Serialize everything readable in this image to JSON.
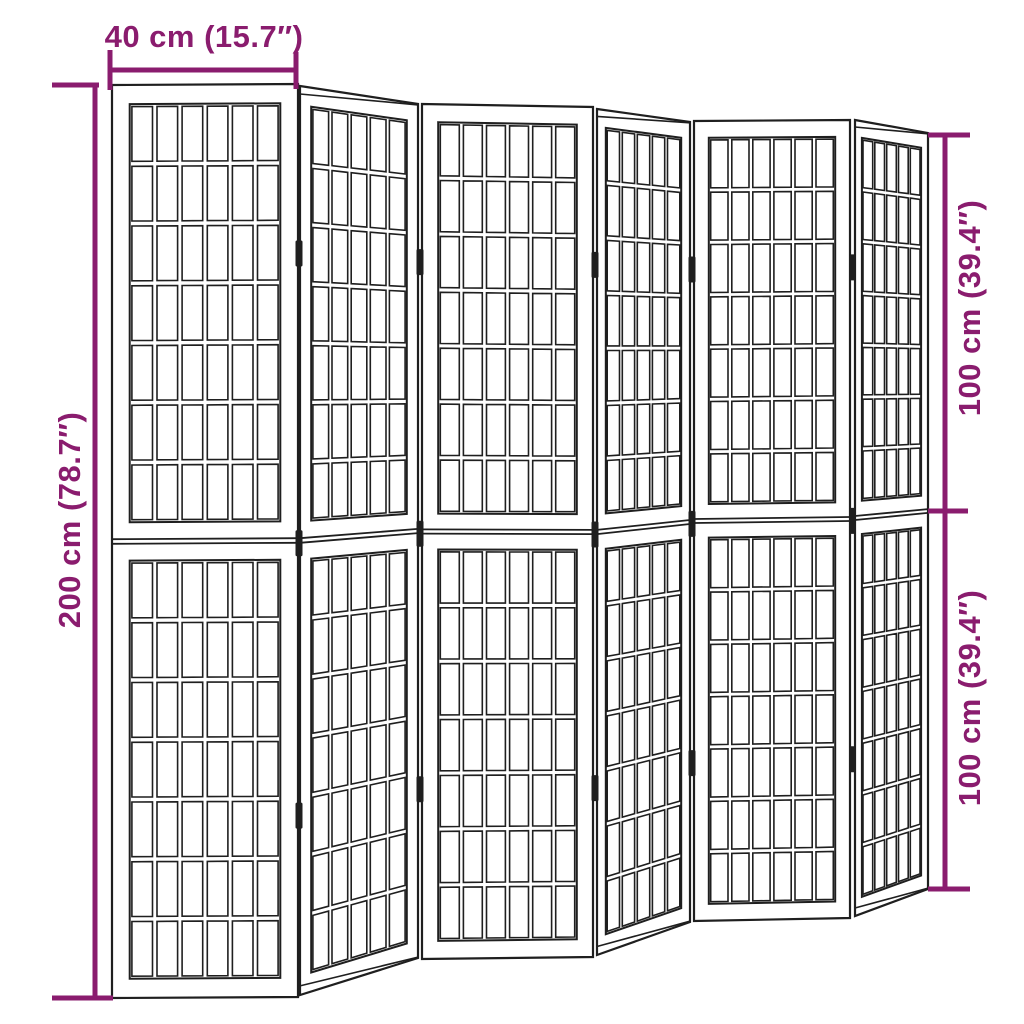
{
  "page": {
    "background": "#ffffff"
  },
  "diagram": {
    "subject": "Folding room divider screen with six lattice panels, shown in zigzag perspective with dimension annotations",
    "colors": {
      "dimension_accent": "#8A1C6E",
      "outline": "#1f1f1f",
      "panel_fill": "#ffffff"
    },
    "dimensions": {
      "top": {
        "label": "40 cm (15.7″)"
      },
      "left": {
        "label": "200 cm (78.7″)"
      },
      "right_top": {
        "label": "100 cm (39.4″)"
      },
      "right_bottom": {
        "label": "100 cm (39.4″)"
      }
    },
    "figure": {
      "panel_count": 6,
      "halves_per_panel": 2,
      "rows_per_half": 7,
      "hinge_positions": [
        0.185,
        0.503,
        0.802
      ],
      "panels": [
        {
          "name": "panel-1",
          "orientation": "front",
          "cols": 6,
          "quad": [
            [
              112,
              85
            ],
            [
              298,
              84
            ],
            [
              298,
              997
            ],
            [
              112,
              998
            ]
          ]
        },
        {
          "name": "panel-2",
          "orientation": "angled",
          "cols": 5,
          "quad": [
            [
              300,
              86
            ],
            [
              418,
              104
            ],
            [
              418,
              958
            ],
            [
              300,
              995
            ]
          ]
        },
        {
          "name": "panel-3",
          "orientation": "front",
          "cols": 6,
          "quad": [
            [
              422,
              104
            ],
            [
              593,
              107
            ],
            [
              593,
              957
            ],
            [
              422,
              959
            ]
          ]
        },
        {
          "name": "panel-4",
          "orientation": "angled",
          "cols": 5,
          "quad": [
            [
              597,
              109
            ],
            [
              690,
              122
            ],
            [
              690,
              922
            ],
            [
              597,
              955
            ]
          ]
        },
        {
          "name": "panel-5",
          "orientation": "front",
          "cols": 6,
          "quad": [
            [
              694,
              121
            ],
            [
              850,
              120
            ],
            [
              850,
              918
            ],
            [
              694,
              921
            ]
          ]
        },
        {
          "name": "panel-6",
          "orientation": "angled",
          "cols": 5,
          "quad": [
            [
              855,
              120
            ],
            [
              928,
              133
            ],
            [
              928,
              889
            ],
            [
              855,
              916
            ]
          ]
        }
      ]
    }
  }
}
